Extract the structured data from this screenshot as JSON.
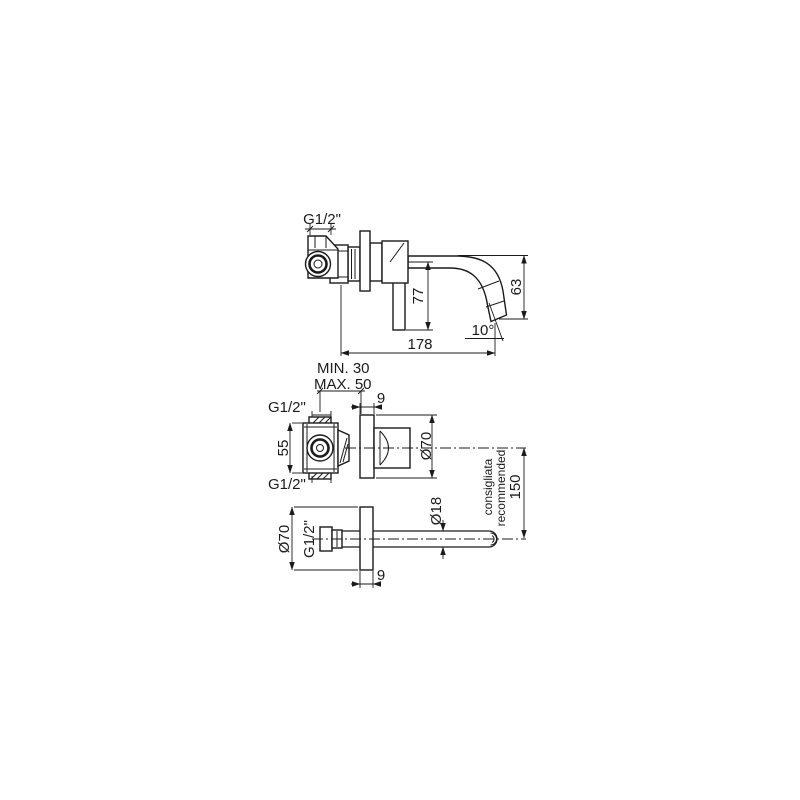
{
  "palette": {
    "background": "#ffffff",
    "line": "#1b1b1b"
  },
  "side_view": {
    "inlet_thread": "G1/2\"",
    "handle_length": "77",
    "spout_drop": "63",
    "spout_angle": "10°",
    "spout_reach": "178"
  },
  "front_view": {
    "min_wall_depth": "MIN. 30",
    "max_wall_depth": "MAX. 50",
    "plate_thickness": "9",
    "top_thread": "G1/2\"",
    "body_height": "55",
    "bottom_thread": "G1/2\"",
    "plate_diameter": "Ø70"
  },
  "spout_view": {
    "plate_diameter": "Ø70",
    "thread": "G1/2\"",
    "tube_diameter": "Ø18",
    "plate_thickness": "9"
  },
  "note": {
    "line1": "consigliata",
    "line2": "recommended",
    "distance": "150"
  }
}
